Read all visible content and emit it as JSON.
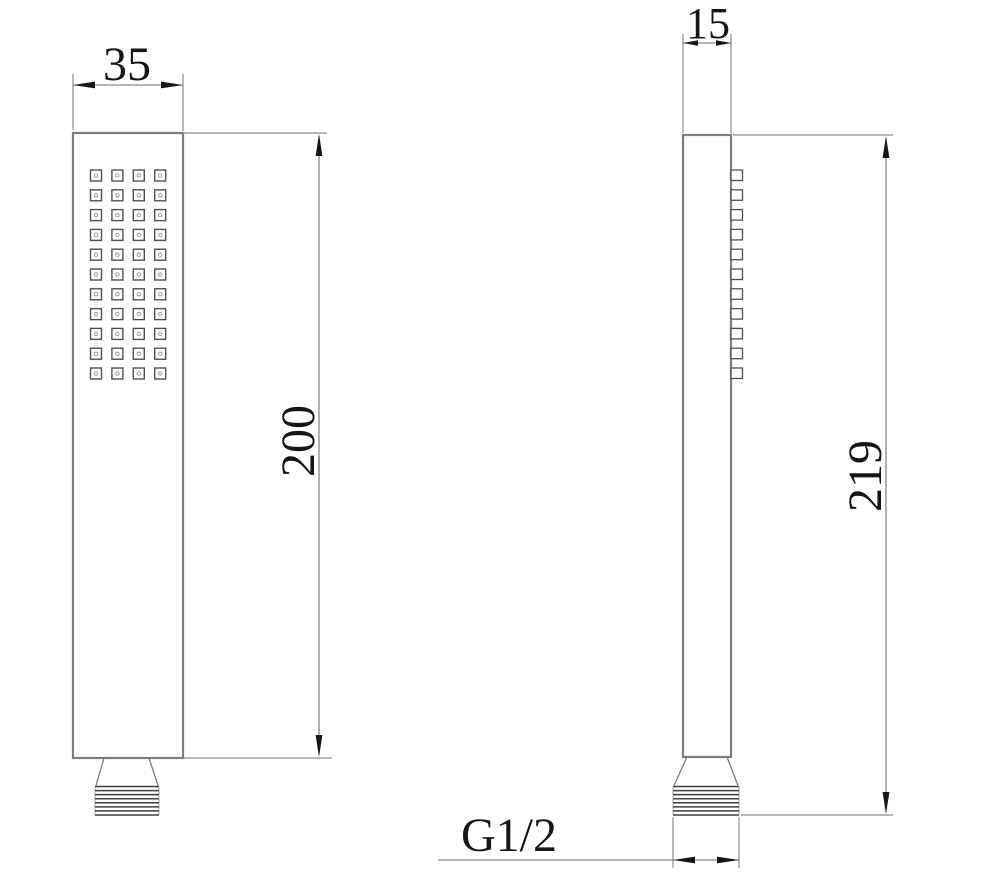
{
  "labels": {
    "front_width_mm": "35",
    "front_body_length_mm": "200",
    "side_depth_mm": "15",
    "side_total_length_mm": "219",
    "thread_spec": "G1/2"
  },
  "geometry": {
    "front_nozzle_grid": {
      "columns": 4,
      "rows": 11
    },
    "side_nozzle_profile_count": 11,
    "thread_ridge_lines": 8
  },
  "colors": {
    "background": "#ffffff",
    "outline": "#7d7d7d",
    "dimension_line": "#8c8c8c",
    "nozzle_outline": "#4f4f4f",
    "thread_line": "#3f3f3f",
    "text": "#161616"
  }
}
